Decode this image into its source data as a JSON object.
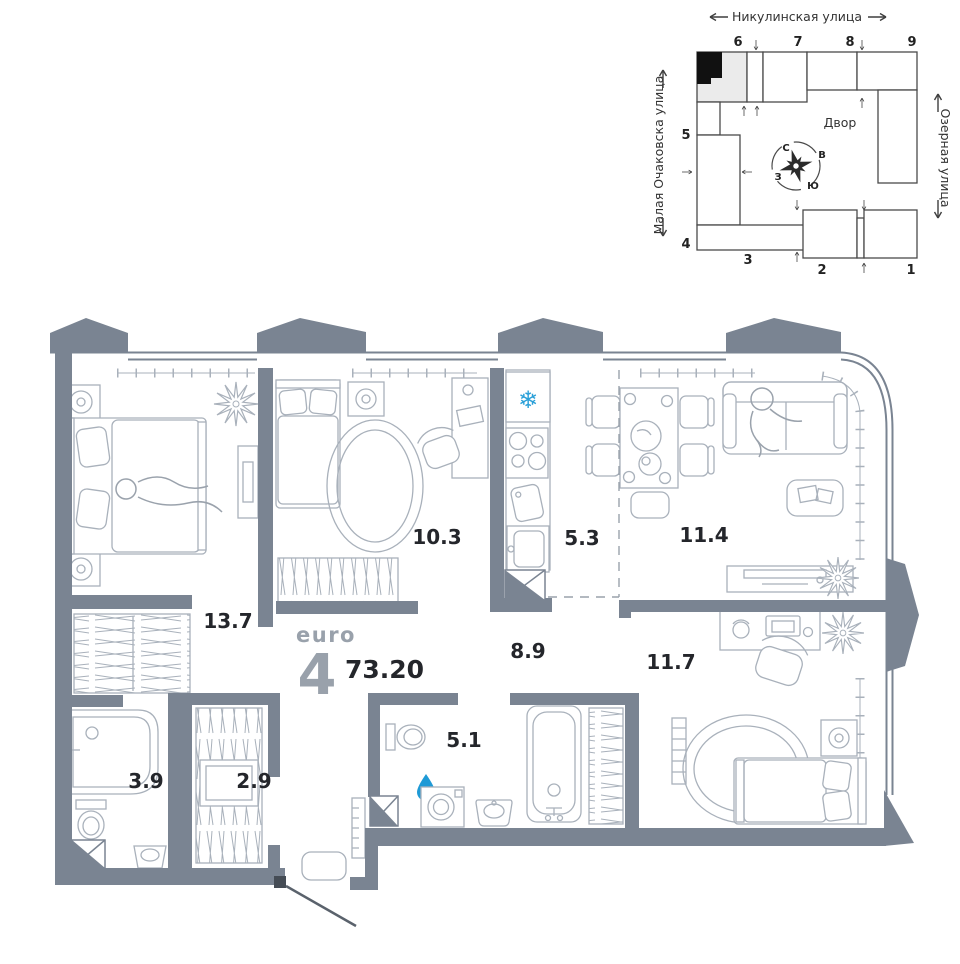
{
  "title": {
    "type_label": "euro",
    "rooms_count": "4",
    "total_area": "73.20"
  },
  "rooms": {
    "bedroom1": "13.7",
    "bedroom2": "10.3",
    "kitchen": "5.3",
    "living": "11.4",
    "hall": "8.9",
    "bedroom3": "11.7",
    "bathroom1": "3.9",
    "wardrobe": "2.9",
    "bathroom2": "5.1"
  },
  "site_plan": {
    "street_top": "Никулинская улица",
    "street_left": "Малая Очаковска улица",
    "street_right": "Озерная улица",
    "courtyard": "Двор",
    "compass": {
      "north": "С",
      "east": "В",
      "south": "Ю",
      "west": "З"
    },
    "building_numbers": [
      "1",
      "2",
      "3",
      "4",
      "5",
      "6",
      "7",
      "8",
      "9"
    ]
  },
  "colors": {
    "wall": "#7a8492",
    "furniture": "#a9b1bb",
    "accent_blue": "#1f9ad6",
    "text": "#24262b",
    "muted": "#99a1ab"
  }
}
